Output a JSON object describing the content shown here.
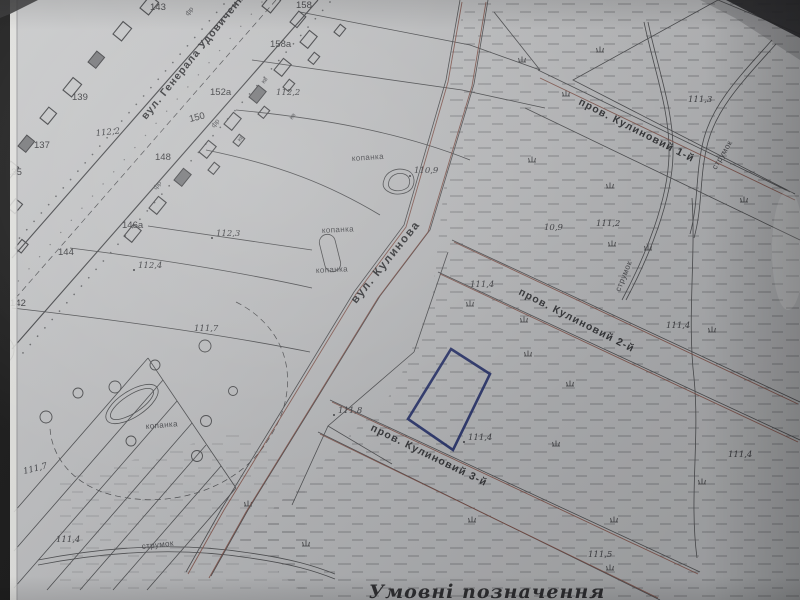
{
  "colors": {
    "paper": "#c4c5c7",
    "ink": "#3e3f42",
    "red_boundary": "#7d4a40",
    "plot_outline": "#1e2a66",
    "photo_edge": "#141414",
    "paper_edge": "#e6e6e3"
  },
  "streets": {
    "udovychenka": "вул. Генерала Удовиченка",
    "kulynova": "вул. Кулинова",
    "lane1": "пров. Кулиновий 1-й",
    "lane2": "пров. Кулиновий 2-й",
    "lane3": "пров. Кулиновий 3-й"
  },
  "hydrography": {
    "stream": "струмок",
    "dug_pond": "копанка"
  },
  "elevations": {
    "e110_9": "110,9",
    "e10_9": "10,9",
    "e111_2": "111,2",
    "e111_3": "111,3",
    "e111_4": "111,4",
    "e111_5": "111,5",
    "e111_7": "111,7",
    "e111_8": "111,8",
    "e112_2": "112,2",
    "e112_3": "112,3",
    "e112_4": "112,4"
  },
  "house_numbers": {
    "h135": "135",
    "h137": "137",
    "h139": "139",
    "h142": "142",
    "h143": "143",
    "h144": "144",
    "h146a": "146а",
    "h148": "148",
    "h150": "150",
    "h152a": "152а",
    "h158": "158",
    "h158a": "158а"
  },
  "building_marks": {
    "frame": "фр",
    "brick": "кв"
  },
  "legend": {
    "title": "Умовні позначення"
  }
}
